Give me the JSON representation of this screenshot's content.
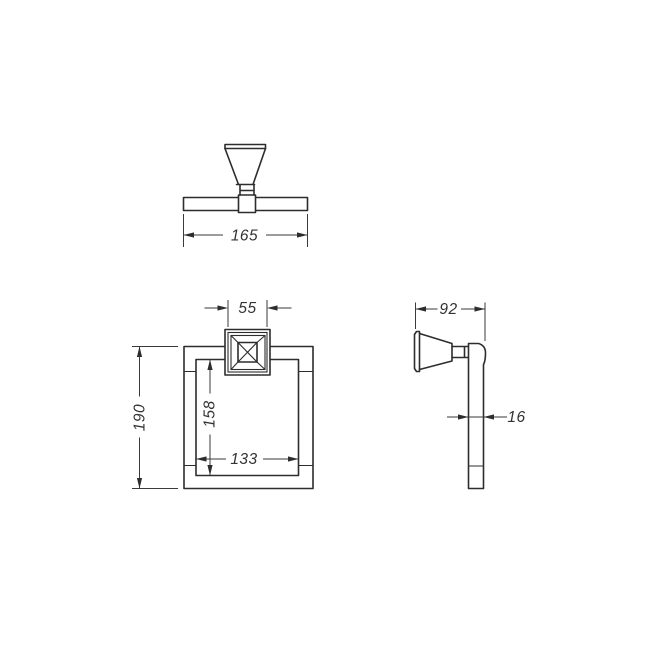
{
  "drawing": {
    "background": "#ffffff",
    "line_color": "#2d2d2d",
    "dims": {
      "top_width": "165",
      "mount_width": "55",
      "overall_height": "190",
      "inner_height": "158",
      "inner_width": "133",
      "depth": "92",
      "bar_thickness": "16"
    }
  }
}
